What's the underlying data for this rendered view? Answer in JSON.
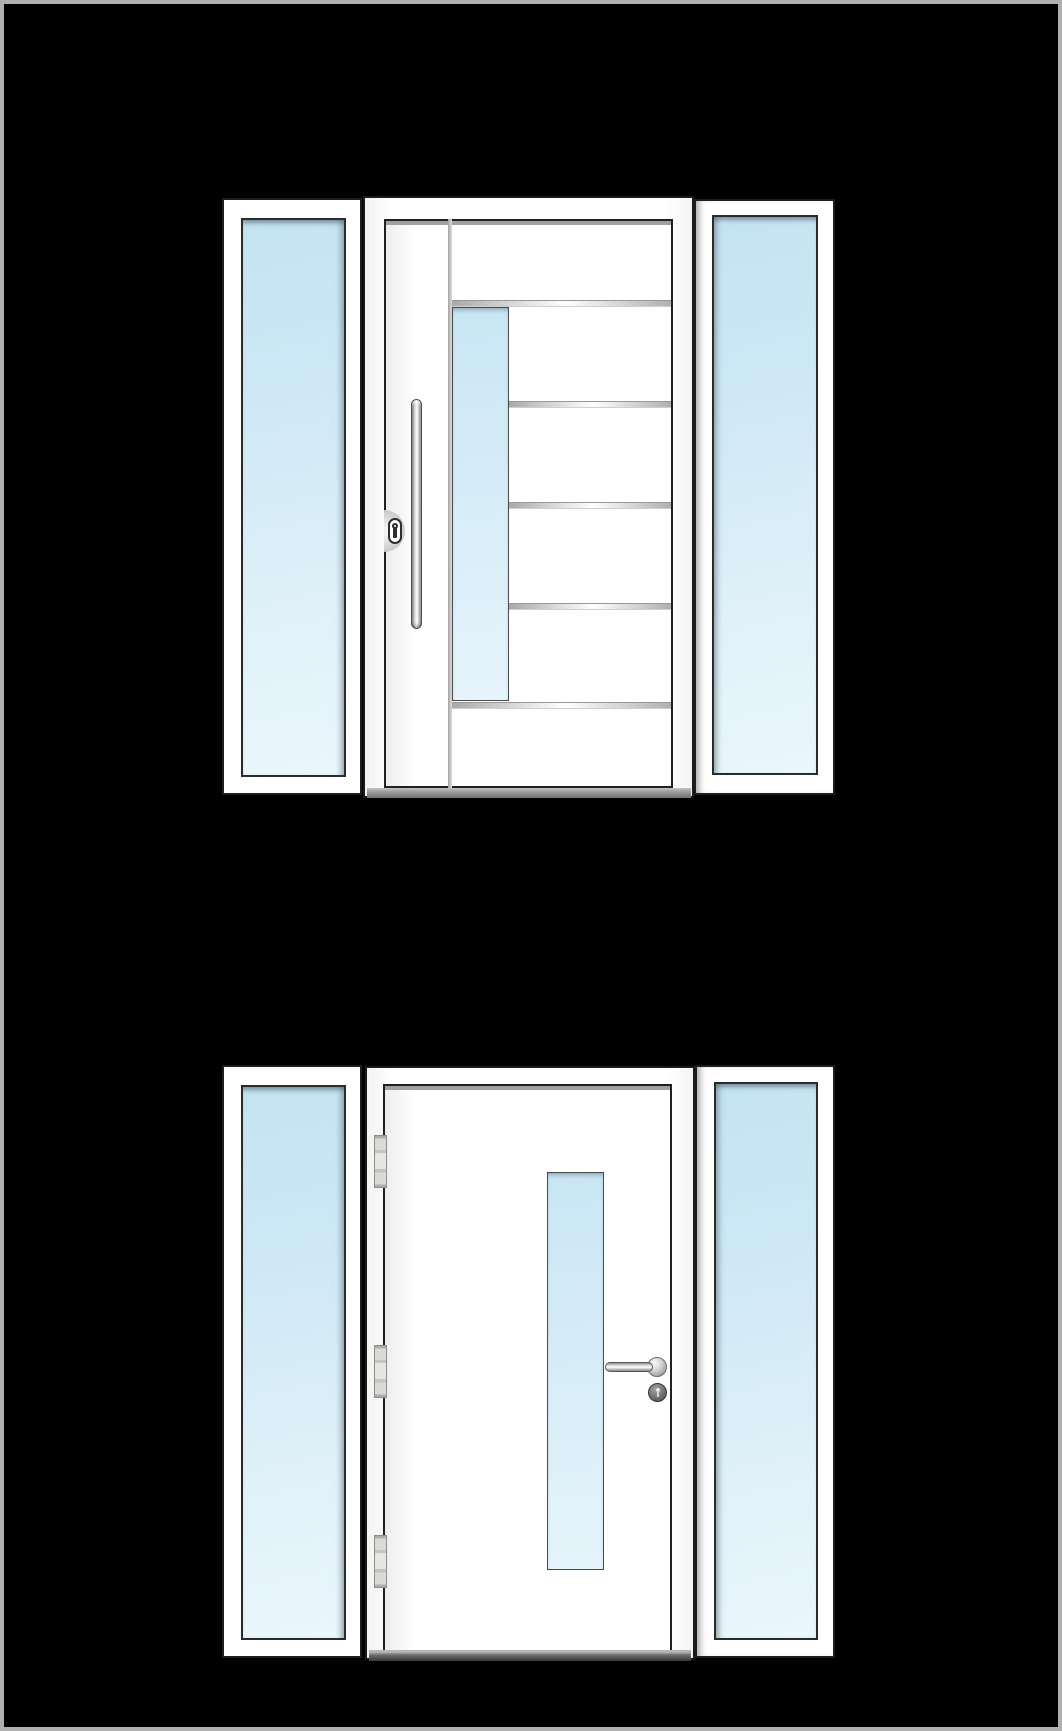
{
  "canvas": {
    "width_px": 1062,
    "height_px": 1731,
    "background": "#000000",
    "border_color": "#b0b0b0"
  },
  "palette": {
    "frame_white": "#ffffff",
    "outline_dark": "#1d1d1d",
    "glass_blue_top": "#c4e3f2",
    "glass_blue_bottom": "#eaf7fc",
    "inox_groove_gray": "#c9c9c9",
    "metal_silver": "#d9d9d9",
    "threshold_gray": "#8f8f8f",
    "threshold_dark": "#383838"
  },
  "products": {
    "top_door": {
      "name": "entry-door-two-sidelights-bar-pull-handle",
      "features": [
        "left-sidelight-glass",
        "right-sidelight-glass",
        "offset-vertical-glazing-strip",
        "horizontal-inox-grooves",
        "vertical-bar-pull-handle",
        "cylinder-lock-escutcheon"
      ],
      "grooves": [
        {
          "x": 230,
          "y": 104,
          "w": 219
        },
        {
          "x": 287,
          "y": 205,
          "w": 162
        },
        {
          "x": 287,
          "y": 306,
          "w": 162
        },
        {
          "x": 287,
          "y": 407,
          "w": 162
        },
        {
          "x": 230,
          "y": 506,
          "w": 219
        }
      ]
    },
    "bottom_door": {
      "name": "entry-door-two-sidelights-lever-handle",
      "features": [
        "left-sidelight-glass",
        "right-sidelight-glass",
        "vertical-glazing-strip",
        "three-hinges",
        "lever-handle",
        "round-cylinder-escutcheon"
      ],
      "hinges": [
        {
          "x": 152,
          "y": 70
        },
        {
          "x": 152,
          "y": 280
        },
        {
          "x": 152,
          "y": 470
        }
      ]
    }
  }
}
